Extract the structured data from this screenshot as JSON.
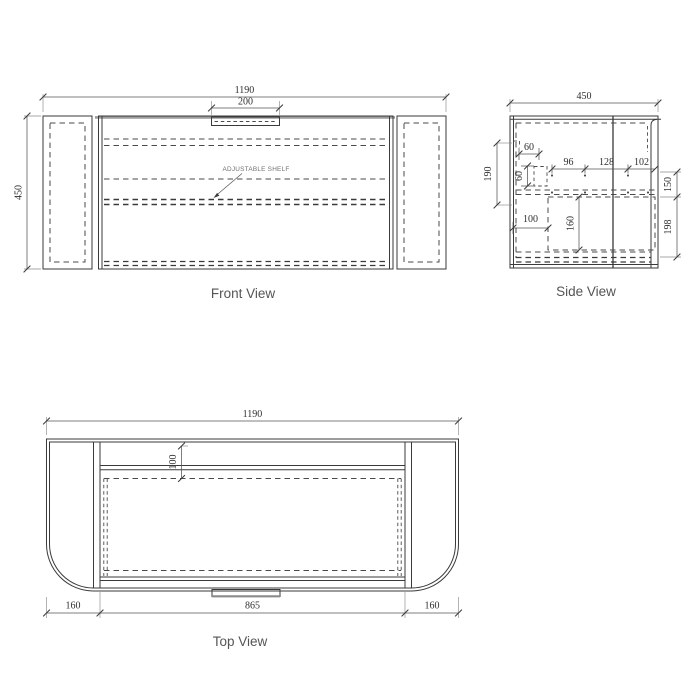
{
  "drawing": {
    "front": {
      "caption": "Front View",
      "width_dim": "1190",
      "handle_dim": "200",
      "height_dim": "450",
      "shelf_label": "ADJUSTABLE SHELF"
    },
    "side": {
      "caption": "Side View",
      "width_dim": "450",
      "back_dim": "190",
      "bracket_w_dim": "60",
      "bracket_h_dim": "60",
      "span1_dim": "96",
      "span2_dim": "128",
      "span3_dim": "102",
      "inset_dim": "100",
      "drawer_h_dim": "160",
      "upper_right_dim": "150",
      "lower_right_dim": "198"
    },
    "top": {
      "caption": "Top View",
      "width_dim": "1190",
      "depth_dim": "100",
      "left_dim": "160",
      "opening_dim": "865",
      "right_dim": "160"
    },
    "colors": {
      "line": "#3a3a3a",
      "dimension": "#555555",
      "caption": "#555555",
      "accent": "#9c9c9c",
      "background": "#ffffff"
    }
  }
}
